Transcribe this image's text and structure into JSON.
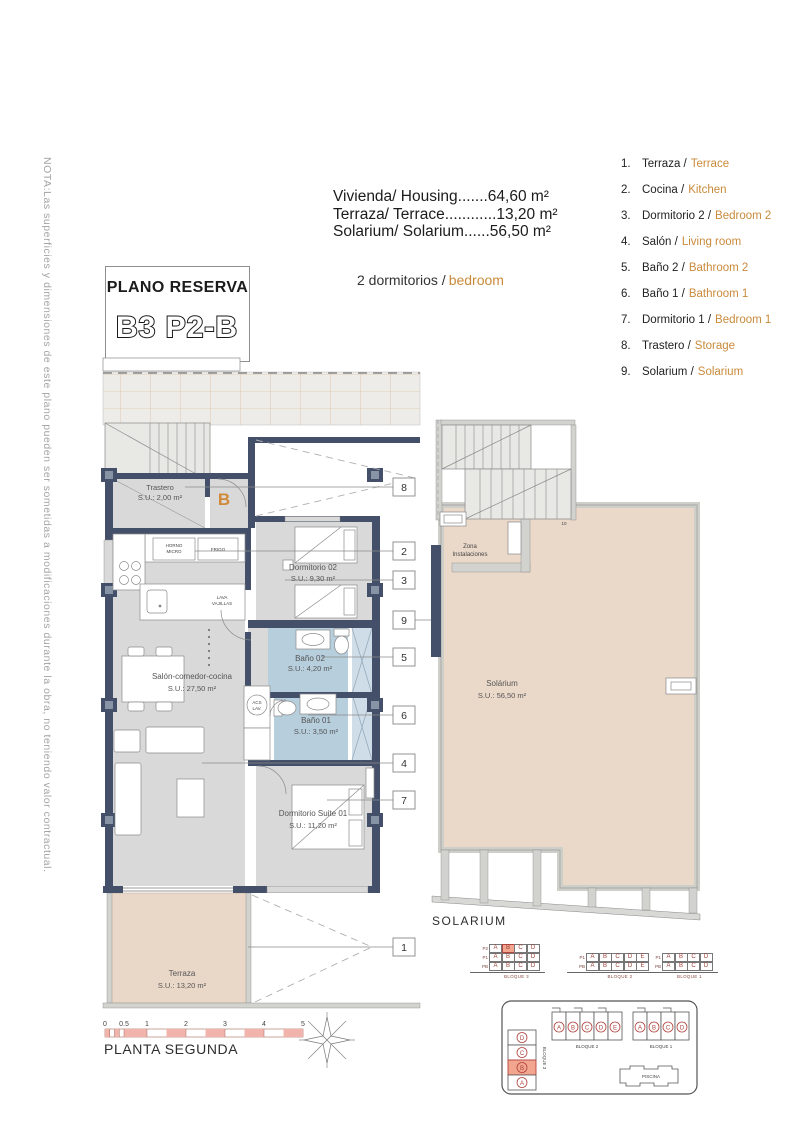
{
  "note": {
    "text": "NOTA:Las superficies y dimensiones de este plano pueden ser sometidas a modificaciones durante la obra, no teniendo valor contractual."
  },
  "title_box": {
    "line1": "PLANO RESERVA",
    "line2": "B3 P2-B"
  },
  "summary": {
    "lines": [
      "Vivienda/ Housing.......64,60 m²",
      "Terraza/ Terrace............13,20 m²",
      "Solarium/ Solarium......56,50 m²"
    ],
    "bedrooms_es": "2 dormitorios /",
    "bedrooms_en": "bedroom"
  },
  "legend": {
    "items": [
      {
        "num": "1.",
        "es": "Terraza /",
        "en": "Terrace"
      },
      {
        "num": "2.",
        "es": "Cocina /",
        "en": "Kitchen"
      },
      {
        "num": "3.",
        "es": "Dormitorio 2 /",
        "en": "Bedroom 2"
      },
      {
        "num": "4.",
        "es": "Salón /",
        "en": "Living room"
      },
      {
        "num": "5.",
        "es": "Baño 2 /",
        "en": "Bathroom 2"
      },
      {
        "num": "6.",
        "es": "Baño 1 /",
        "en": "Bathroom 1"
      },
      {
        "num": "7.",
        "es": "Dormitorio 1 /",
        "en": "Bedroom 1"
      },
      {
        "num": "8.",
        "es": "Trastero /",
        "en": "Storage"
      },
      {
        "num": "9.",
        "es": "Solarium /",
        "en": "Solarium"
      }
    ]
  },
  "plan": {
    "rooms": {
      "trastero": {
        "name": "Trastero",
        "area": "S.U.: 2,00 m²"
      },
      "dorm02": {
        "name": "Dormitorio 02",
        "area": "S.U.: 9,30 m²"
      },
      "bano02": {
        "name": "Baño 02",
        "area": "S.U.: 4,20 m²"
      },
      "salon": {
        "name": "Salón-comedor-cocina",
        "area": "S.U.: 27,50 m²"
      },
      "bano01": {
        "name": "Baño 01",
        "area": "S.U.: 3,50 m²"
      },
      "suite": {
        "name": "Dormitorio Suite 01",
        "area": "S.U.: 11,20 m²"
      },
      "terraza": {
        "name": "Terraza",
        "area": "S.U.: 13,20 m²"
      }
    },
    "kitchen": {
      "horno1": "HORNO",
      "horno2": "MICRO",
      "frigo": "FRIGO",
      "lava1": "LAVA",
      "lava2": "VAJILLAS",
      "acs1": "ACS",
      "acs2": "LAV."
    },
    "entrance_letter": "B",
    "callouts": [
      "8",
      "2",
      "3",
      "9",
      "5",
      "6",
      "4",
      "7",
      "1"
    ]
  },
  "solarium": {
    "name": "Solárium",
    "area": "S.U.: 56,50 m²",
    "zona1": "Zona",
    "zona2": "Instalaciones",
    "caption": "SOLARIUM",
    "step_label": "10"
  },
  "footer": {
    "ticks": [
      "0",
      "0.5",
      "1",
      "2",
      "3",
      "4",
      "5"
    ],
    "caption": "PLANTA SEGUNDA"
  },
  "blocks": {
    "b3": {
      "label": "BLOQUE 3",
      "floors": [
        {
          "name": "P2",
          "cells": [
            "A",
            "B",
            "C",
            "D"
          ],
          "highlight": "B"
        },
        {
          "name": "P1",
          "cells": [
            "A",
            "B",
            "C",
            "D"
          ]
        },
        {
          "name": "PB",
          "cells": [
            "A",
            "B",
            "C",
            "D"
          ]
        }
      ]
    },
    "b2": {
      "label": "BLOQUE 2",
      "floors": [
        {
          "name": "P1",
          "cells": [
            "A",
            "B",
            "C",
            "D",
            "E"
          ]
        },
        {
          "name": "PB",
          "cells": [
            "A",
            "B",
            "C",
            "D",
            "E"
          ]
        }
      ]
    },
    "b1": {
      "label": "BLOQUE 1",
      "floors": [
        {
          "name": "P1",
          "cells": [
            "A",
            "B",
            "C",
            "D"
          ]
        },
        {
          "name": "PB",
          "cells": [
            "A",
            "B",
            "C",
            "D"
          ]
        }
      ]
    }
  },
  "siteplan": {
    "b2": {
      "label": "BLOQUE 2",
      "units": [
        "A",
        "B",
        "C",
        "D",
        "E"
      ]
    },
    "b1": {
      "label": "BLOQUE 1",
      "units": [
        "A",
        "B",
        "C",
        "D"
      ]
    },
    "b3": {
      "label": "BLOQUE 3",
      "units": [
        "D",
        "C",
        "B",
        "A"
      ],
      "highlighted": "B"
    },
    "pool": "PISCINA"
  },
  "colors": {
    "accent_orange": "#c98a3b",
    "wall_dark": "#44506a",
    "bathroom_blue": "#b7cedd",
    "terrace_beige": "#e9d7c8",
    "highlight_salmon": "#f2a58f",
    "scalebar_pink": "#f0b4ac",
    "table_red": "#9c3f38"
  }
}
